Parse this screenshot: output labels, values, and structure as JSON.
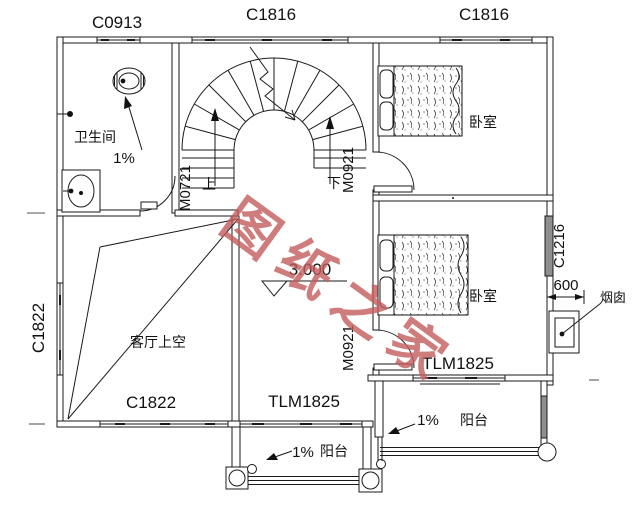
{
  "windows": {
    "c0913": "C0913",
    "c1816_mid": "C1816",
    "c1816_right": "C1816",
    "c1822_left": "C1822",
    "c1822_bottom": "C1822",
    "c1216_right": "C1216"
  },
  "doors": {
    "bathroom": "M0721",
    "bedroom_top": "M0921",
    "bedroom_right": "M0921",
    "balcony_right": "TLM1825",
    "balcony_bottom": "TLM1825"
  },
  "rooms": {
    "bathroom": "卫生间",
    "bedroom_top": "卧室",
    "bedroom_right": "卧室",
    "living_void": "客厅上空",
    "balcony_right": "阳台",
    "balcony_bottom": "阳台"
  },
  "stairs": {
    "up": "上",
    "down": "下"
  },
  "annotations": {
    "bath_slope": "1%",
    "balcony_right_slope": "1%",
    "balcony_bottom_slope": "1%",
    "elevation": "3.000",
    "chimney": "烟囱",
    "chimney_width": "600"
  },
  "watermark": {
    "text": "图纸之家",
    "color": "#c45c5c"
  },
  "colors": {
    "line": "#1a1a1a",
    "window_gray": "#8f8f8f"
  }
}
